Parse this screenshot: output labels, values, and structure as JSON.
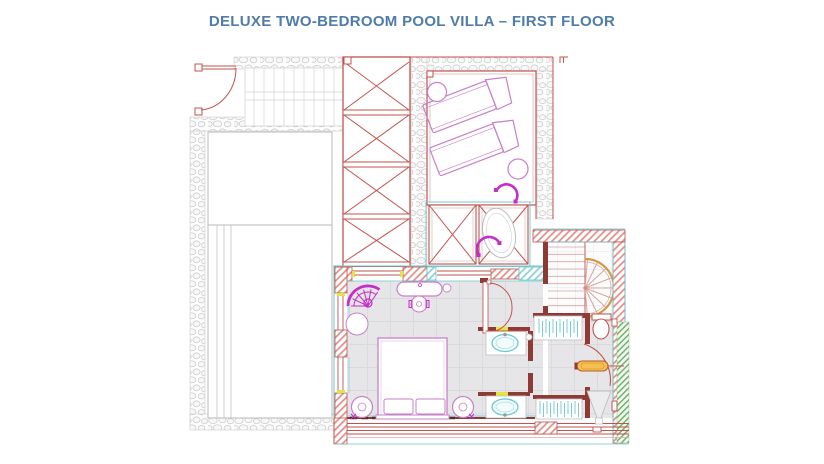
{
  "title": "DELUXE TWO-BEDROOM POOL VILLA – FIRST FLOOR",
  "colors": {
    "title_blue": "#4f7ca8",
    "cad_red": "#c0534e",
    "dark_red": "#8e3b35",
    "magenta": "#c42ec9",
    "pink": "#c97fc7",
    "cyan": "#6cc8ce",
    "stone_gray": "#c9c9c9",
    "floor_gray": "#e6e6e9",
    "grid_gray": "#d9d9de",
    "orange": "#d29a44",
    "amber": "#f4c054",
    "yellow": "#e3e43e",
    "green": "#72b06c",
    "light_gray": "#bdbdbd"
  }
}
